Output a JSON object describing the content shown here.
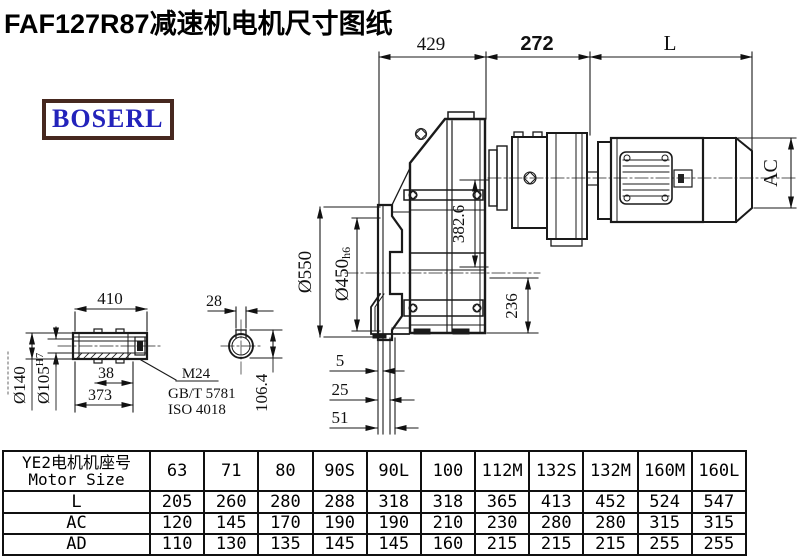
{
  "title": "FAF127R87减速机电机尺寸图纸",
  "logo": {
    "text": "BOSERL"
  },
  "drawing": {
    "dims": {
      "top_left": "429",
      "top_mid": "272",
      "top_right": "L",
      "motor_height": "AC",
      "center_height": "382.6",
      "bottom_height": "236",
      "flange_od": "Ø550",
      "spigot_d": "Ø450",
      "spigot_fit": "h6",
      "t5": "5",
      "t25": "25",
      "t51": "51",
      "shaft_len": "410",
      "s38": "38",
      "s373": "373",
      "thread": "M24",
      "std1": "GB/T 5781",
      "std2": "ISO 4018",
      "shaft_od": "Ø140",
      "bore_d": "Ø105",
      "bore_fit": "H7",
      "key_w": "28",
      "key_h": "106.4"
    },
    "colors": {
      "line": "#1a1a1a",
      "centerline": "#555555",
      "logo_border": "#46281f",
      "logo_text": "#2323bb"
    }
  },
  "table": {
    "header_col1_line1": "YE2电机机座号",
    "header_col1_line2": "Motor Size",
    "columns": [
      "63",
      "71",
      "80",
      "90S",
      "90L",
      "100",
      "112M",
      "132S",
      "132M",
      "160M",
      "160L"
    ],
    "rows": [
      {
        "label": "L",
        "values": [
          "205",
          "260",
          "280",
          "288",
          "318",
          "318",
          "365",
          "413",
          "452",
          "524",
          "547"
        ]
      },
      {
        "label": "AC",
        "values": [
          "120",
          "145",
          "170",
          "190",
          "190",
          "210",
          "230",
          "280",
          "280",
          "315",
          "315"
        ]
      },
      {
        "label": "AD",
        "values": [
          "110",
          "130",
          "135",
          "145",
          "145",
          "160",
          "215",
          "215",
          "215",
          "255",
          "255"
        ]
      }
    ]
  }
}
